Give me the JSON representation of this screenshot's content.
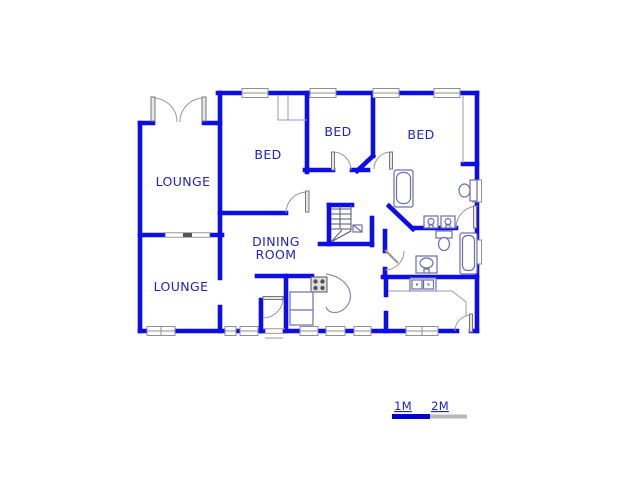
{
  "plan": {
    "rooms": [
      {
        "id": "lounge-top",
        "label": "LOUNGE"
      },
      {
        "id": "bed-1",
        "label": "BED"
      },
      {
        "id": "bed-2",
        "label": "BED"
      },
      {
        "id": "bed-3",
        "label": "BED"
      },
      {
        "id": "dining-room",
        "label_line_1": "DINING",
        "label_line_2": "ROOM"
      },
      {
        "id": "lounge-bottom",
        "label": "LOUNGE"
      }
    ],
    "fixtures": [
      "staircase",
      "bathtub-master",
      "bathtub-main",
      "toilet-master",
      "toilet-main",
      "double-vanity",
      "pedestal-sink",
      "kitchen-double-sink",
      "stove",
      "kitchen-counter",
      "scullery-counter",
      "built-in-closet"
    ]
  },
  "scale": {
    "label_1m": "1M",
    "label_2m": "2M"
  },
  "colors": {
    "background": "#ffffff",
    "wall": "#0d0de8",
    "room_label": "#2323bb",
    "fixture_line": "#6d6dae",
    "door_arc": "#999999",
    "window_frame": "#8f8f8f",
    "scale_blue": "#0000d0",
    "scale_gray": "#b9b9b9"
  }
}
